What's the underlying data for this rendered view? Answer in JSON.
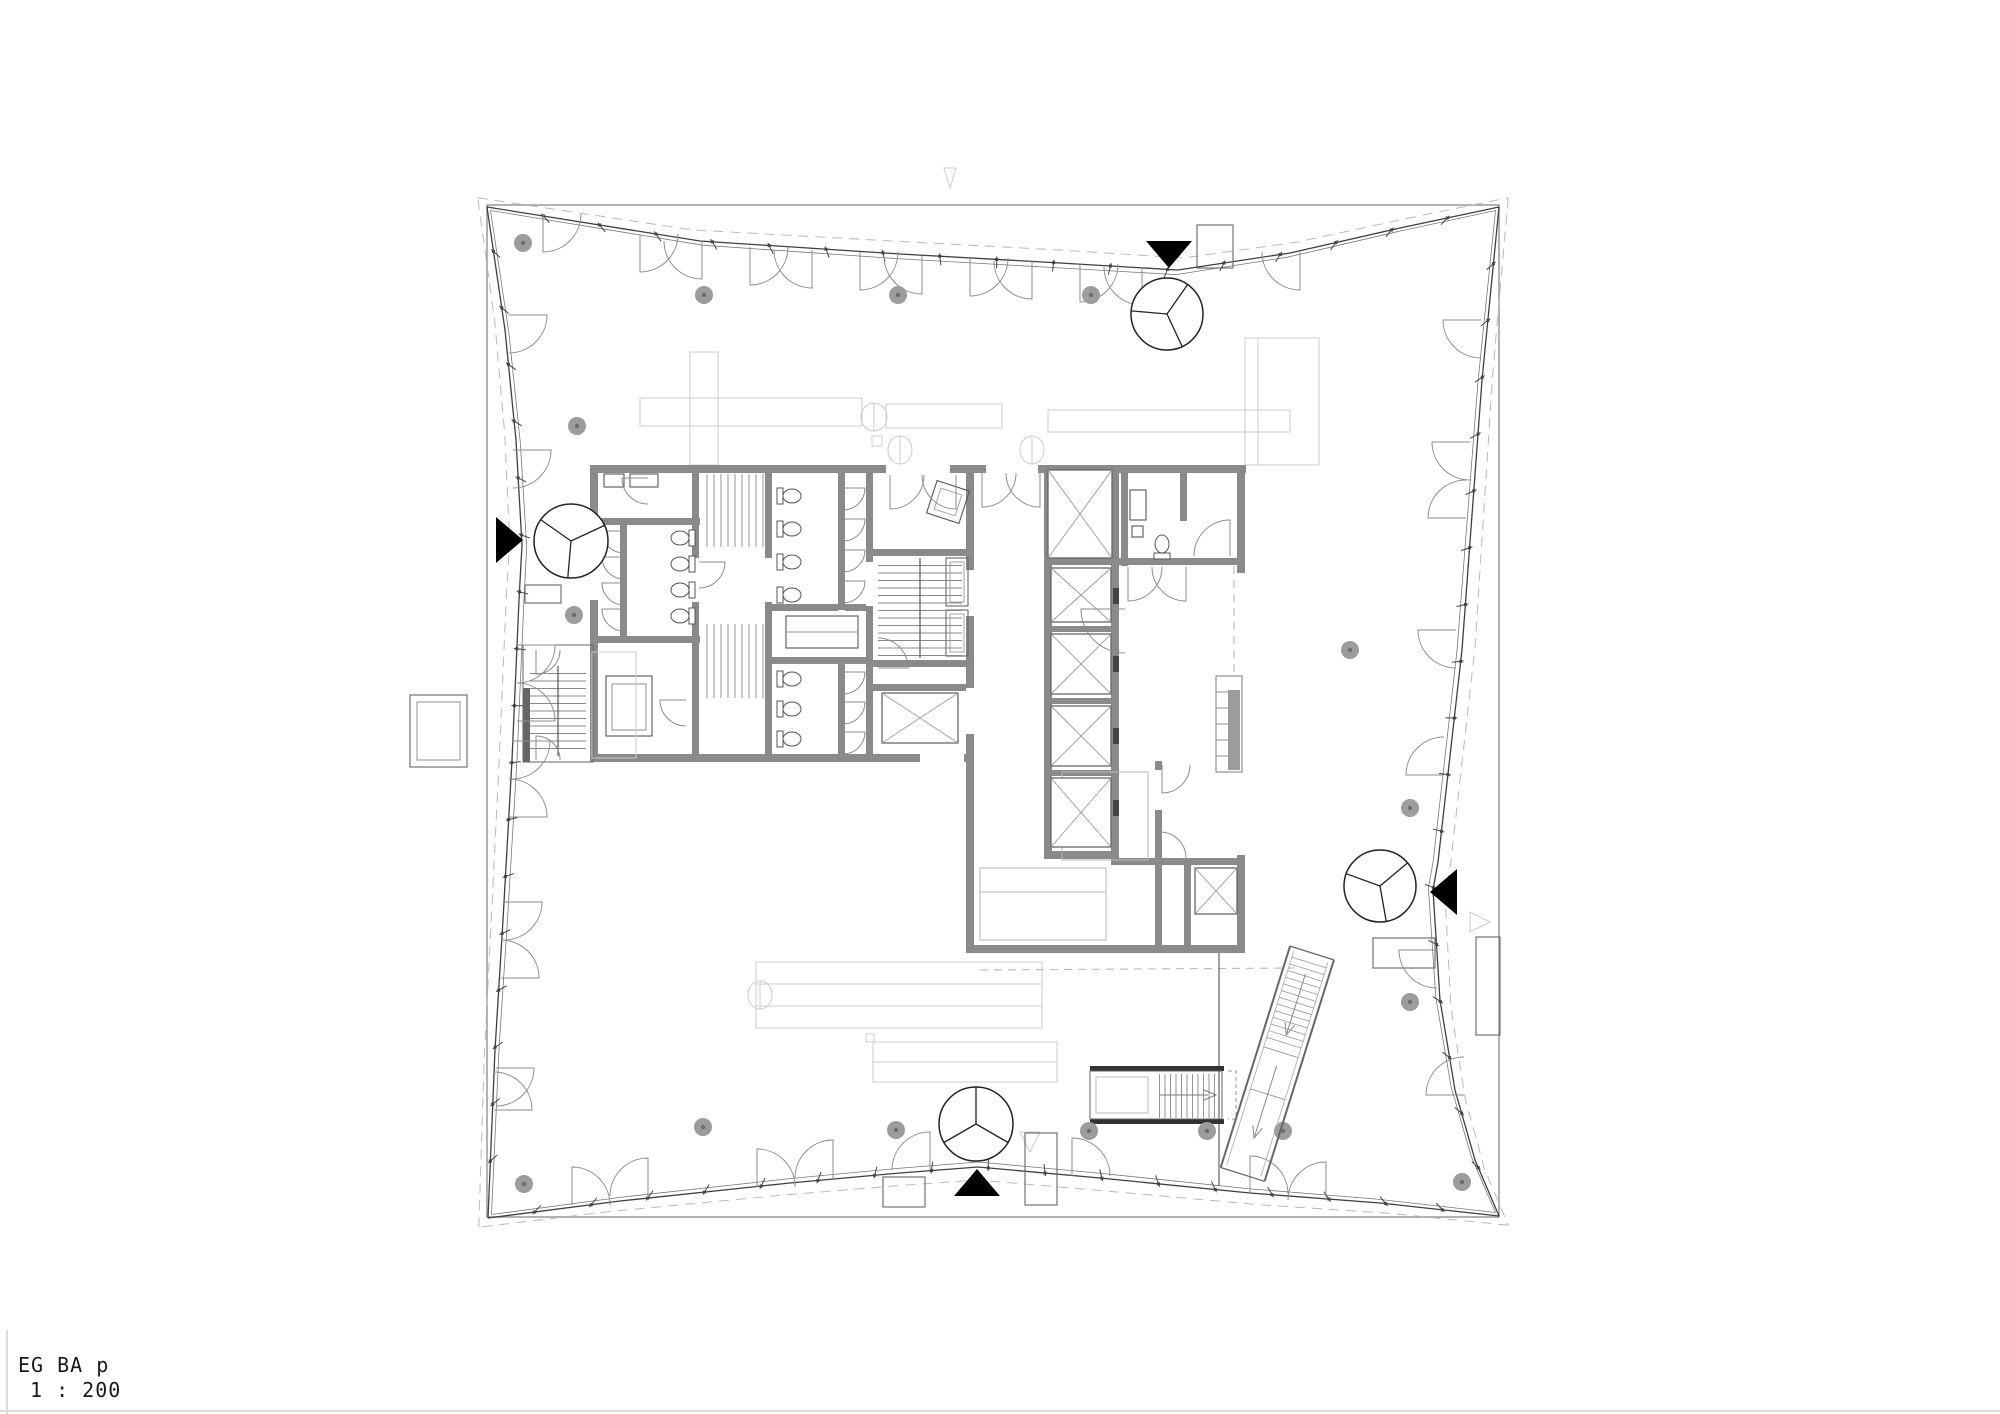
{
  "meta": {
    "drawing_title": "EG BA p",
    "drawing_scale": "1 : 200"
  },
  "colors": {
    "line": "#3f3f3f",
    "line2": "#777777",
    "wall": "#8a8a8a",
    "door": "#8c8c8c",
    "faint": "#cccccc",
    "dash": "#b9b9b9",
    "column": "#9c9c9c",
    "column_dot": "#6e6e6e",
    "black": "#000000",
    "dark": "#444444",
    "mid": "#666666",
    "tread": "#888888",
    "sheet_edge": "#dddddd",
    "boundary": "#999999"
  },
  "plan": {
    "outer_boundary": {
      "x": 487,
      "y": 205,
      "w": 1012,
      "h": 1012
    },
    "centroid": [
      993,
      711
    ],
    "mullion_spacing": 57,
    "facade_sides": [
      {
        "name": "north",
        "pts": [
          [
            487,
            207
          ],
          [
            700,
            241
          ],
          [
            900,
            254
          ],
          [
            1060,
            263
          ],
          [
            1178,
            270
          ],
          [
            1290,
            253
          ],
          [
            1400,
            228
          ],
          [
            1499,
            207
          ]
        ]
      },
      {
        "name": "east",
        "pts": [
          [
            1499,
            207
          ],
          [
            1482,
            380
          ],
          [
            1462,
            650
          ],
          [
            1438,
            862
          ],
          [
            1433,
            890
          ],
          [
            1440,
            1000
          ],
          [
            1455,
            1090
          ],
          [
            1475,
            1160
          ],
          [
            1499,
            1216
          ]
        ]
      },
      {
        "name": "south",
        "pts": [
          [
            1499,
            1216
          ],
          [
            1380,
            1203
          ],
          [
            1250,
            1193
          ],
          [
            1100,
            1178
          ],
          [
            978,
            1167
          ],
          [
            900,
            1173
          ],
          [
            790,
            1183
          ],
          [
            620,
            1201
          ],
          [
            488,
            1218
          ]
        ]
      },
      {
        "name": "west",
        "pts": [
          [
            488,
            1218
          ],
          [
            495,
            1050
          ],
          [
            503,
            920
          ],
          [
            512,
            760
          ],
          [
            519,
            600
          ],
          [
            522,
            545
          ],
          [
            516,
            440
          ],
          [
            505,
            330
          ],
          [
            487,
            207
          ]
        ]
      }
    ],
    "entrances": [
      {
        "name": "north",
        "triangle": {
          "cx": 1169,
          "cy": 254,
          "dir": "down"
        },
        "revolving": {
          "cx": 1167,
          "cy": 314,
          "r": 36,
          "rot": 185
        }
      },
      {
        "name": "west",
        "triangle": {
          "cx": 509,
          "cy": 540,
          "dir": "right"
        },
        "revolving": {
          "cx": 571,
          "cy": 541,
          "r": 37,
          "rot": 95
        }
      },
      {
        "name": "south",
        "triangle": {
          "cx": 977,
          "cy": 1183,
          "dir": "up"
        },
        "revolving": {
          "cx": 976,
          "cy": 1124,
          "r": 37,
          "rot": 30
        }
      },
      {
        "name": "east",
        "triangle": {
          "cx": 1444,
          "cy": 892,
          "dir": "left"
        },
        "revolving": {
          "cx": 1380,
          "cy": 886,
          "r": 36,
          "rot": 80
        }
      }
    ],
    "columns": [
      [
        523,
        243
      ],
      [
        704,
        295
      ],
      [
        898,
        295
      ],
      [
        1091,
        295
      ],
      [
        577,
        426
      ],
      [
        574,
        615
      ],
      [
        1350,
        650
      ],
      [
        1410,
        808
      ],
      [
        1410,
        1002
      ],
      [
        703,
        1127
      ],
      [
        524,
        1184
      ],
      [
        896,
        1130
      ],
      [
        1089,
        1131
      ],
      [
        1207,
        1131
      ],
      [
        1283,
        1131
      ],
      [
        1462,
        1182
      ]
    ],
    "walls": [
      [
        590,
        465,
        656,
        8
      ],
      [
        590,
        465,
        8,
        297
      ],
      [
        590,
        754,
        384,
        8
      ],
      [
        692,
        465,
        7,
        297
      ],
      [
        765,
        465,
        7,
        297
      ],
      [
        866,
        465,
        7,
        297
      ],
      [
        966,
        465,
        8,
        297
      ],
      [
        590,
        518,
        110,
        7
      ],
      [
        620,
        518,
        7,
        125
      ],
      [
        590,
        636,
        110,
        7
      ],
      [
        838,
        472,
        7,
        140
      ],
      [
        772,
        604,
        101,
        7
      ],
      [
        772,
        657,
        101,
        7
      ],
      [
        838,
        664,
        7,
        98
      ],
      [
        872,
        549,
        95,
        7
      ],
      [
        872,
        660,
        95,
        7
      ],
      [
        872,
        684,
        95,
        7
      ],
      [
        1044,
        465,
        8,
        394
      ],
      [
        1111,
        465,
        8,
        394
      ],
      [
        1121,
        465,
        7,
        101
      ],
      [
        1180,
        465,
        7,
        56
      ],
      [
        1237,
        465,
        8,
        108
      ],
      [
        1111,
        558,
        134,
        7
      ],
      [
        1044,
        558,
        75,
        7
      ],
      [
        1051,
        626,
        61,
        6
      ],
      [
        1051,
        698,
        61,
        6
      ],
      [
        1051,
        770,
        61,
        6
      ],
      [
        1044,
        851,
        75,
        8
      ],
      [
        966,
        761,
        8,
        192
      ],
      [
        1155,
        761,
        7,
        192
      ],
      [
        966,
        945,
        279,
        8
      ],
      [
        1111,
        858,
        134,
        7
      ],
      [
        1184,
        858,
        7,
        95
      ],
      [
        1237,
        855,
        8,
        98
      ]
    ],
    "wall_gaps": [
      [
        966,
        570,
        8,
        46
      ],
      [
        966,
        688,
        8,
        46
      ],
      [
        692,
        558,
        7,
        44
      ],
      [
        765,
        558,
        7,
        44
      ],
      [
        866,
        562,
        7,
        44
      ],
      [
        838,
        610,
        7,
        44
      ],
      [
        1155,
        770,
        7,
        40
      ],
      [
        886,
        465,
        64,
        8
      ],
      [
        986,
        465,
        52,
        8
      ],
      [
        590,
        560,
        8,
        40
      ],
      [
        920,
        754,
        44,
        8
      ]
    ],
    "doors": [
      [
        543,
        214,
        38,
        0,
        0
      ],
      [
        640,
        234,
        38,
        0,
        0
      ],
      [
        702,
        241,
        38,
        0,
        1
      ],
      [
        750,
        247,
        38,
        0,
        0
      ],
      [
        812,
        250,
        38,
        0,
        1
      ],
      [
        860,
        252,
        38,
        0,
        0
      ],
      [
        922,
        256,
        38,
        0,
        1
      ],
      [
        970,
        258,
        38,
        0,
        0
      ],
      [
        1032,
        261,
        38,
        0,
        1
      ],
      [
        1080,
        264,
        38,
        0,
        0
      ],
      [
        1142,
        267,
        38,
        0,
        1
      ],
      [
        1300,
        252,
        38,
        0,
        1
      ],
      [
        1481,
        320,
        38,
        90,
        0
      ],
      [
        1470,
        442,
        38,
        90,
        0
      ],
      [
        1466,
        518,
        38,
        90,
        1
      ],
      [
        1456,
        630,
        38,
        90,
        0
      ],
      [
        1444,
        775,
        38,
        90,
        1
      ],
      [
        1437,
        950,
        38,
        90,
        0
      ],
      [
        1464,
        1095,
        38,
        90,
        1
      ],
      [
        572,
        1205,
        38,
        180,
        1
      ],
      [
        648,
        1196,
        38,
        180,
        0
      ],
      [
        757,
        1187,
        38,
        180,
        1
      ],
      [
        833,
        1178,
        38,
        180,
        0
      ],
      [
        930,
        1170,
        38,
        180,
        0
      ],
      [
        1072,
        1176,
        38,
        180,
        1
      ],
      [
        1250,
        1194,
        38,
        180,
        1
      ],
      [
        1326,
        1200,
        38,
        180,
        0
      ],
      [
        509,
        315,
        38,
        270,
        1
      ],
      [
        513,
        450,
        38,
        270,
        1
      ],
      [
        517,
        645,
        38,
        270,
        1
      ],
      [
        517,
        721,
        38,
        270,
        0
      ],
      [
        512,
        741,
        38,
        270,
        1
      ],
      [
        509,
        817,
        38,
        270,
        0
      ],
      [
        504,
        902,
        38,
        270,
        1
      ],
      [
        501,
        978,
        38,
        270,
        0
      ],
      [
        496,
        1068,
        38,
        270,
        1
      ],
      [
        494,
        1110,
        38,
        270,
        0
      ],
      [
        890,
        475,
        34,
        0,
        0
      ],
      [
        956,
        475,
        34,
        0,
        1
      ],
      [
        982,
        473,
        34,
        0,
        0
      ],
      [
        1040,
        473,
        34,
        0,
        1
      ],
      [
        1128,
        567,
        34,
        0,
        0
      ],
      [
        1186,
        567,
        34,
        0,
        1
      ],
      [
        1125,
        609,
        44,
        90,
        0
      ],
      [
        1230,
        556,
        36,
        180,
        0
      ],
      [
        878,
        668,
        30,
        270,
        0
      ],
      [
        699,
        562,
        26,
        270,
        1
      ],
      [
        686,
        700,
        26,
        90,
        0
      ],
      [
        648,
        478,
        26,
        90,
        0
      ],
      [
        624,
        531,
        22,
        90,
        0
      ],
      [
        624,
        557,
        22,
        90,
        0
      ],
      [
        624,
        583,
        22,
        90,
        0
      ],
      [
        624,
        609,
        22,
        90,
        0
      ],
      [
        843,
        488,
        22,
        270,
        1
      ],
      [
        843,
        519,
        22,
        270,
        1
      ],
      [
        843,
        550,
        22,
        270,
        1
      ],
      [
        843,
        581,
        22,
        270,
        1
      ],
      [
        843,
        672,
        22,
        270,
        1
      ],
      [
        843,
        702,
        22,
        270,
        1
      ],
      [
        843,
        732,
        22,
        270,
        1
      ],
      [
        536,
        650,
        24,
        0,
        0
      ],
      [
        536,
        760,
        24,
        180,
        1
      ],
      [
        1160,
        858,
        26,
        180,
        1
      ],
      [
        1162,
        765,
        28,
        0,
        0
      ]
    ],
    "stairs": [
      {
        "x": 700,
        "y": 474,
        "w": 64,
        "h": 73,
        "dir": "h",
        "step": 7,
        "rail": 0
      },
      {
        "x": 700,
        "y": 624,
        "w": 64,
        "h": 74,
        "dir": "h",
        "step": 7,
        "rail": 0
      },
      {
        "x": 878,
        "y": 558,
        "w": 84,
        "h": 100,
        "dir": "v",
        "step": 7.5,
        "rail": 1
      },
      {
        "x": 530,
        "y": 666,
        "w": 56,
        "h": 90,
        "dir": "v",
        "step": 7.5,
        "rail": 1
      },
      {
        "x": 1154,
        "y": 1074,
        "w": 64,
        "h": 44,
        "dir": "h",
        "step": 5.5,
        "rail": 0
      }
    ],
    "xshafts": [
      [
        882,
        693,
        76,
        50
      ],
      [
        1048,
        470,
        64,
        88
      ],
      [
        1051,
        568,
        60,
        54
      ],
      [
        1051,
        634,
        60,
        60
      ],
      [
        1051,
        706,
        60,
        60
      ],
      [
        1051,
        778,
        60,
        69
      ],
      [
        1195,
        868,
        42,
        46
      ]
    ],
    "toilets": [
      [
        682,
        538,
        90
      ],
      [
        682,
        564,
        90
      ],
      [
        682,
        590,
        90
      ],
      [
        682,
        616,
        90
      ],
      [
        790,
        496,
        270
      ],
      [
        790,
        529,
        270
      ],
      [
        790,
        562,
        270
      ],
      [
        790,
        595,
        270
      ],
      [
        790,
        679,
        270
      ],
      [
        790,
        709,
        270
      ],
      [
        790,
        739,
        270
      ],
      [
        1162,
        546,
        180
      ]
    ],
    "escalator": {
      "x": 1312,
      "y": 953,
      "rot": 17.4,
      "len": 232,
      "halfw": 23,
      "tread_from": 10,
      "tread_to": 96,
      "step": 7
    }
  }
}
